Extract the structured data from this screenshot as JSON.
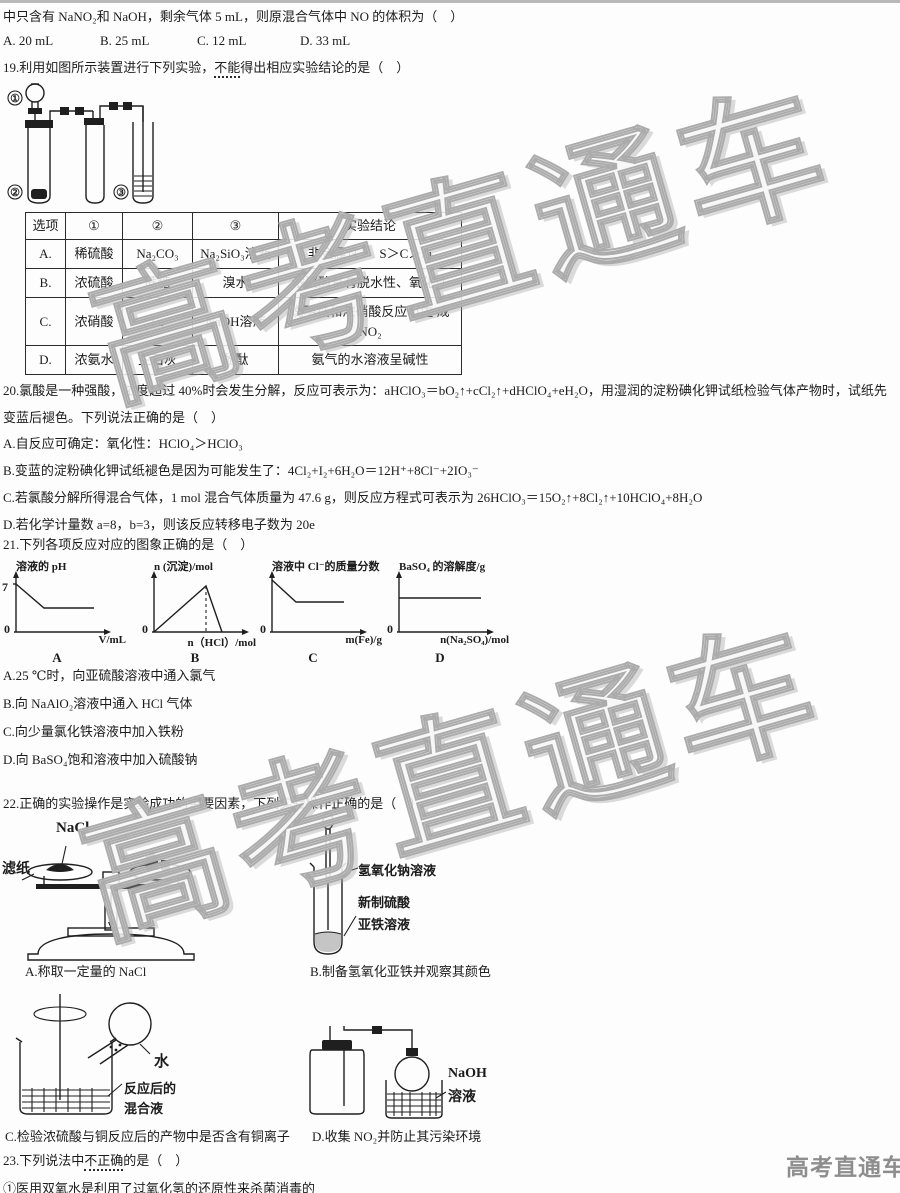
{
  "meta": {
    "watermark_text": "高考直通车",
    "brand_footer": "高考直通车"
  },
  "q18": {
    "tail_line": "中只含有 NaNO₂和 NaOH，剩余气体 5 mL，则原混合气体中 NO 的体积为（　）",
    "options": {
      "a": "A. 20 mL",
      "b": "B. 25 mL",
      "c": "C. 12 mL",
      "d": "D. 33 mL"
    }
  },
  "q19": {
    "stem_prefix": "19.利用如图所示装置进行下列实验，",
    "stem_emph": "不能",
    "stem_suffix": "得出相应实验结论的是（　）",
    "apparatus": {
      "n1": "①",
      "n2": "②",
      "n3": "③"
    },
    "table": {
      "headers": [
        "选项",
        "①",
        "②",
        "③",
        "实验结论"
      ],
      "rows": [
        {
          "opt": "A.",
          "c1": "稀硫酸",
          "c2": "Na₂CO₃",
          "c3": "Na₂SiO₃溶液",
          "concl": "非金属性：　S＞C＞Si"
        },
        {
          "opt": "B.",
          "c1": "浓硫酸",
          "c2": "蔗糖",
          "c3": "溴水",
          "concl": "浓硫酸具有脱水性、氧化性"
        },
        {
          "opt": "C.",
          "c1": "浓硝酸",
          "c2": "Fe",
          "c3": "NaOH溶液",
          "concl": "说明铁和浓硝酸反应可生 成　NO₂"
        },
        {
          "opt": "D.",
          "c1": "浓氨水",
          "c2": "生石灰",
          "c3": "酚酞",
          "concl": "氨气的水溶液呈碱性"
        }
      ]
    }
  },
  "q20": {
    "stem": "20.氯酸是一种强酸，浓度超过 40%时会发生分解，反应可表示为：aHClO₃＝bO₂↑+cCl₂↑+dHClO₄+eH₂O，用湿润的淀粉碘化钾试纸检验气体产物时，试纸先变蓝后褪色。下列说法正确的是（　）",
    "options": [
      "A.自反应可确定：氧化性：HClO₄＞HClO₃",
      "B.变蓝的淀粉碘化钾试纸褪色是因为可能发生了：4Cl₂+I₂+6H₂O＝12H⁺+8Cl⁻+2IO₃⁻",
      "C.若氯酸分解所得混合气体，1 mol 混合气体质量为 47.6 g，则反应方程式可表示为 26HClO₃＝15O₂↑+8Cl₂↑+10HClO₄+8H₂O",
      "D.若化学计量数 a=8，b=3，则该反应转移电子数为 20e"
    ]
  },
  "q21": {
    "stem": "21.下列各项反应对应的图象正确的是（　）",
    "graphs": [
      {
        "type": "line",
        "ylabel": "溶液的 pH",
        "ytick": "7",
        "origin": "0",
        "xlabel": "V/mL",
        "caption": "A"
      },
      {
        "type": "line",
        "ylabel": "n (沉淀)/mol",
        "origin": "0",
        "xlabel": "n（HCl）/mol",
        "caption": "B"
      },
      {
        "type": "line",
        "ylabel": "溶液中 Cl⁻的质量分数",
        "origin": "0",
        "xlabel": "m(Fe)/g",
        "caption": "C"
      },
      {
        "type": "line",
        "ylabel": "BaSO₄ 的溶解度/g",
        "origin": "0",
        "xlabel": "n(Na₂SO₄)/mol",
        "caption": "D"
      }
    ],
    "options": [
      "A.25 ℃时，向亚硫酸溶液中通入氯气",
      "B.向 NaAlO₂溶液中通入 HCl 气体",
      "C.向少量氯化铁溶液中加入铁粉",
      "D.向 BaSO₄饱和溶液中加入硫酸钠"
    ]
  },
  "q22": {
    "stem": "22.正确的实验操作是实验成功的重要因素，下列实验操作正确的是（　）",
    "balance": {
      "nacl": "NaCl",
      "filter_paper": "滤纸",
      "caption": "A.称取一定量的 NaCl"
    },
    "tube": {
      "naoh": "氢氧化钠溶液",
      "feso4_line1": "新制硫酸",
      "feso4_line2": "亚铁溶液",
      "caption": "B.制备氢氧化亚铁并观察其颜色"
    },
    "beaker": {
      "water": "水",
      "mix_line1": "反应后的",
      "mix_line2": "混合液",
      "caption": "C.检验浓硫酸与铜反应后的产物中是否含有铜离子"
    },
    "collect": {
      "naoh_line1": "NaOH",
      "naoh_line2": "溶液",
      "caption": "D.收集 NO₂并防止其污染环境"
    }
  },
  "q23": {
    "stem_prefix": "23.下列说法中",
    "stem_emph": "不正确",
    "stem_suffix": "的是（　）",
    "item1": "①医用双氧水是利用了过氧化氢的还原性来杀菌消毒的"
  }
}
